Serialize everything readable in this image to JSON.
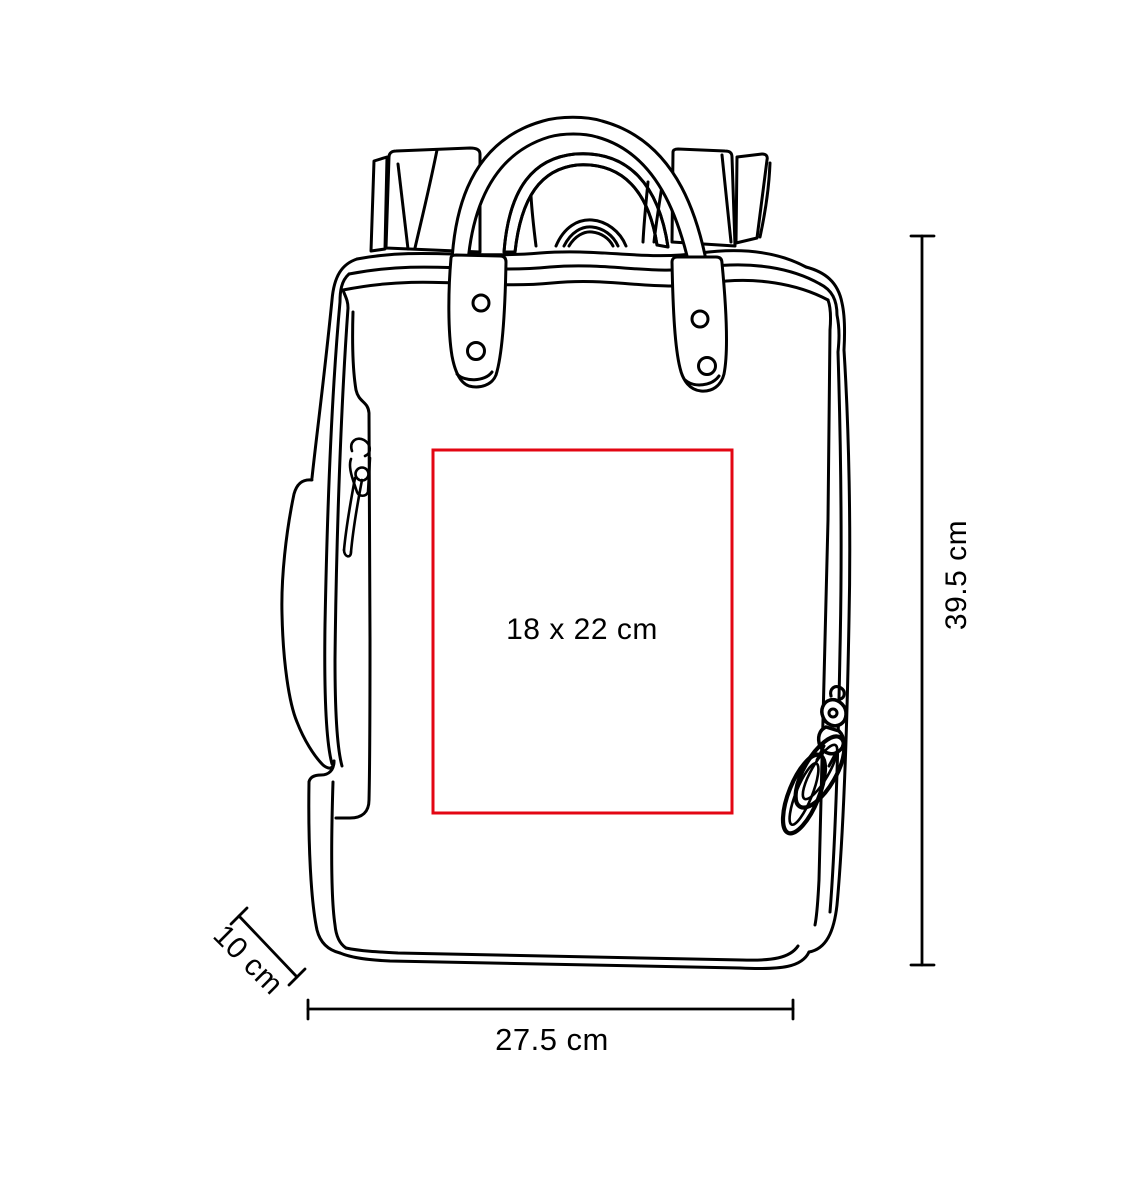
{
  "figure": "backpack-front-view-line-drawing",
  "colors": {
    "line": "#000000",
    "print_area": "#e30613",
    "text": "#000000",
    "background": "#ffffff"
  },
  "print_area": {
    "label": "18 x 22 cm",
    "width_cm": 18,
    "height_cm": 22
  },
  "dimensions": {
    "height": {
      "label": "39.5 cm",
      "value_cm": 39.5,
      "orientation": "vertical"
    },
    "width": {
      "label": "27.5 cm",
      "value_cm": 27.5,
      "orientation": "horizontal"
    },
    "depth": {
      "label": "10 cm",
      "value_cm": 10,
      "orientation": "diagonal"
    }
  }
}
